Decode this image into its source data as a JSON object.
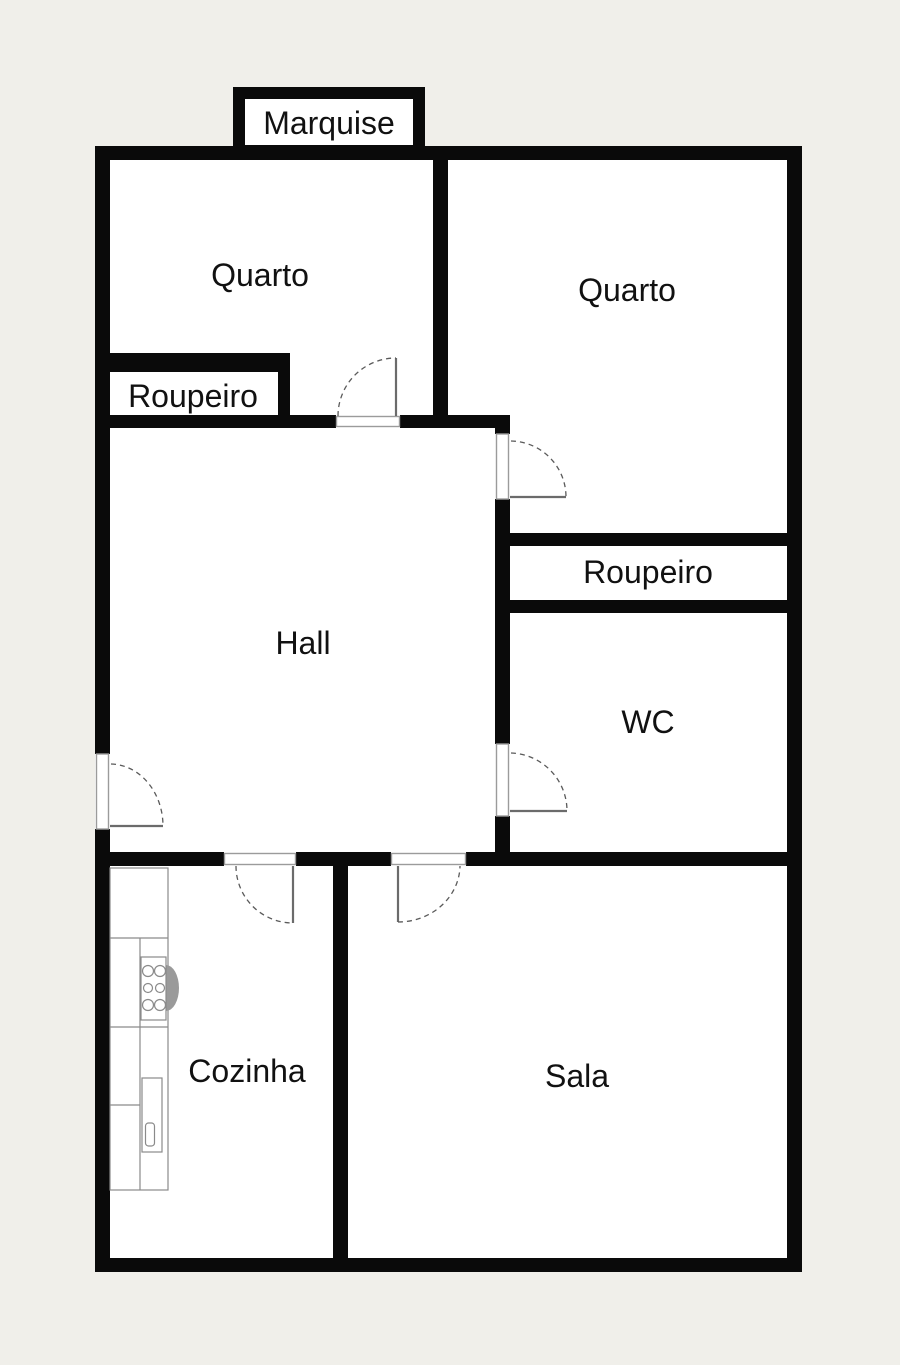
{
  "plan": {
    "type": "apartment-floor-plan",
    "labels": {
      "marquise": "Marquise",
      "quarto_left": "Quarto",
      "quarto_right": "Quarto",
      "roupeiro_left": "Roupeiro",
      "roupeiro_right": "Roupeiro",
      "hall": "Hall",
      "wc": "WC",
      "cozinha": "Cozinha",
      "sala": "Sala"
    },
    "colors": {
      "background": "#f0efea",
      "wall": "#0a0a0a",
      "floor": "#ffffff",
      "door_frame": "#9b9b9b",
      "door_leaf": "#6b6b6b",
      "swing_arc": "#5a5a5a",
      "fixture_line": "#8a8a8a",
      "label_text": "#111111"
    }
  }
}
